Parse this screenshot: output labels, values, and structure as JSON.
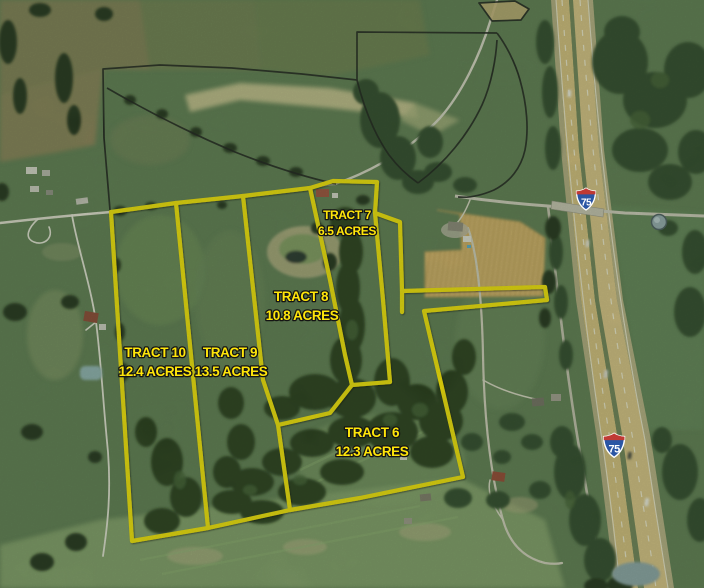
{
  "map": {
    "tract_labels": [
      {
        "tract": "TRACT 6",
        "acreage": "12.3 ACRES"
      },
      {
        "tract": "TRACT 7",
        "acreage": "6.5 ACRES"
      },
      {
        "tract": "TRACT 8",
        "acreage": "10.8 ACRES"
      },
      {
        "tract": "TRACT 9",
        "acreage": "13.5 ACRES"
      },
      {
        "tract": "TRACT 10",
        "acreage": "12.4 ACRES"
      }
    ],
    "highway_shields": [
      {
        "route": "75"
      },
      {
        "route": "75"
      }
    ],
    "colors": {
      "tract_boundary_yellow": "#f8e400",
      "label_yellow": "#ffe60a",
      "parcel_line_black": "#161616",
      "highway_pavement": "#d7bd7c",
      "shield_blue": "#2b56a4",
      "shield_red": "#c03a34"
    }
  }
}
